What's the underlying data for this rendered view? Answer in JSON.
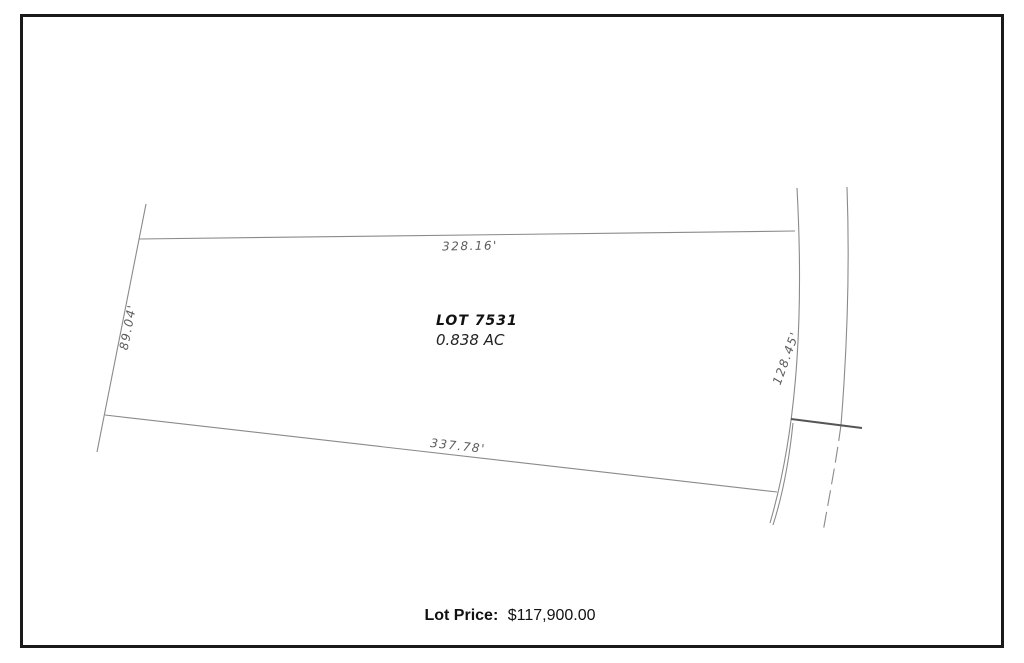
{
  "plat": {
    "lot": {
      "name": "LOT 7531",
      "area": "0.838 AC"
    },
    "dimensions": {
      "north": "328.16'",
      "south": "337.78'",
      "west": "89.04'",
      "east": "128.45'"
    },
    "linework": {
      "boundary_line_color": "#8a8a8a",
      "tick_color": "#555555",
      "border_color": "#1a1a1a",
      "background": "#ffffff"
    }
  },
  "footer": {
    "price_label": "Lot Price:",
    "price_value": "$117,900.00"
  }
}
